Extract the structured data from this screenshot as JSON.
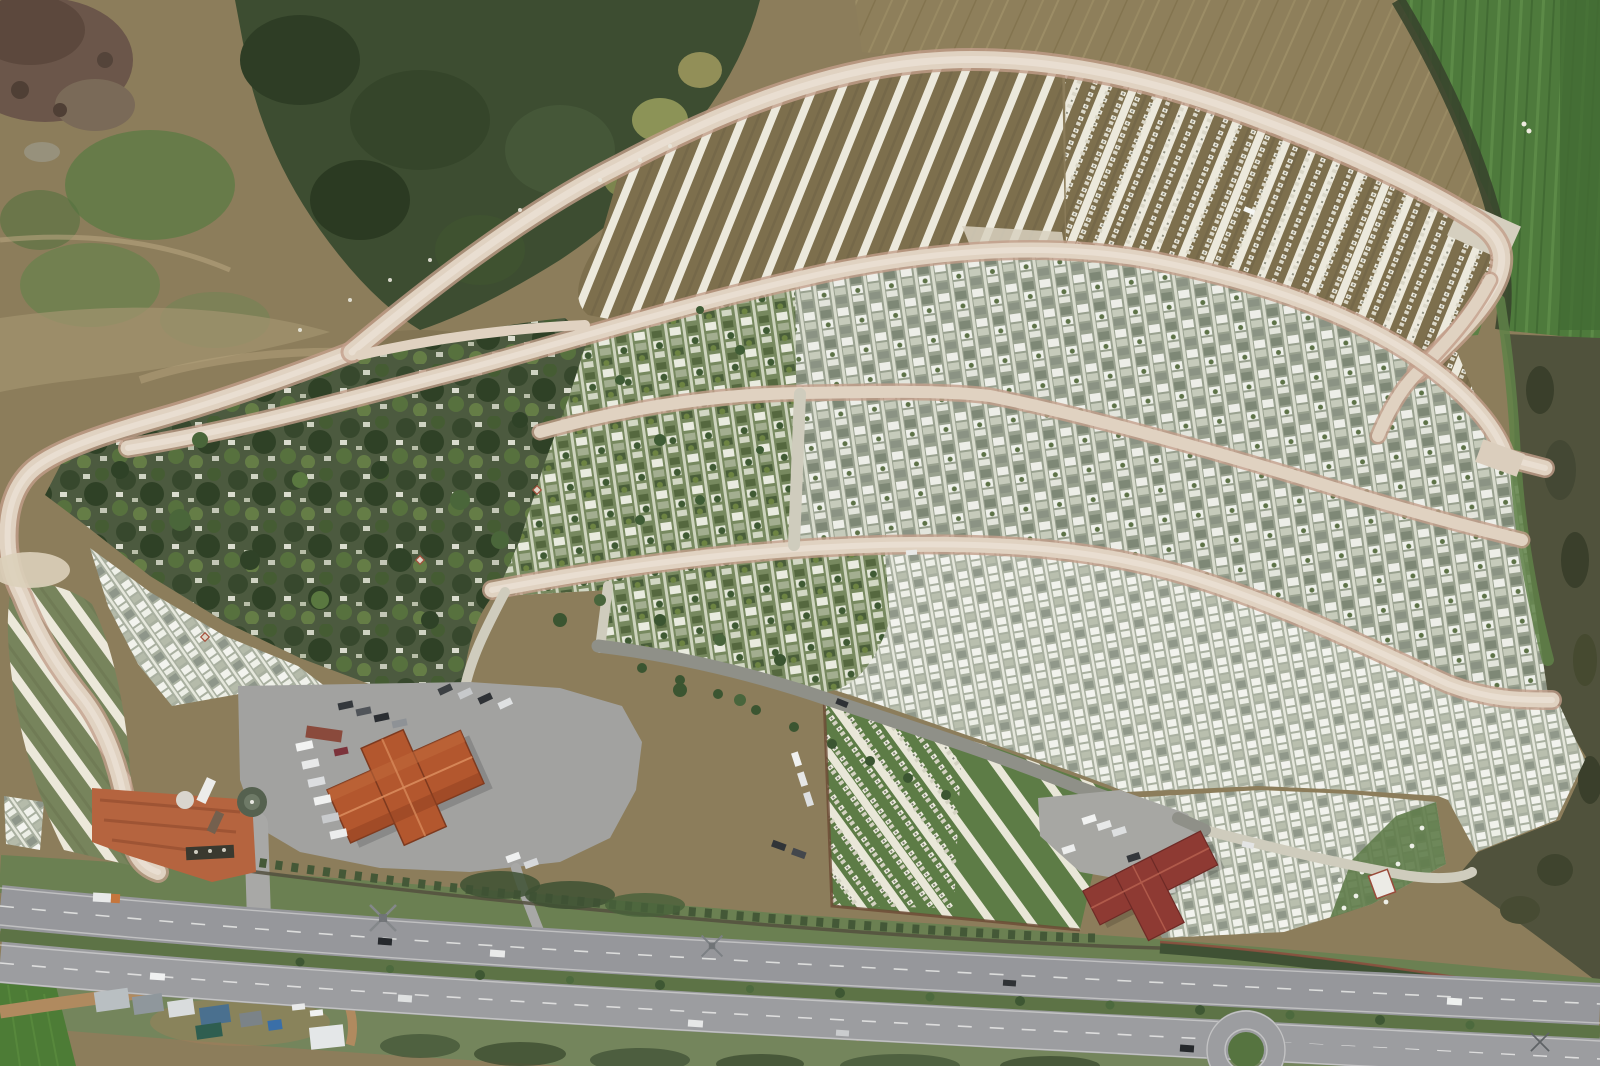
{
  "scene": {
    "type": "aerial-drone-photo",
    "subject": "large hillside cemetery complex with terraced grave rows, service buildings and a divided highway",
    "buildings": 2,
    "roundabouts": 1,
    "highway_carriageways": 2
  },
  "palette": {
    "earth": "#8c7d5b",
    "earth_dark": "#74654a",
    "rubble": "#6b564a",
    "rubble_dark": "#5c483d",
    "forest": "#3d4d31",
    "forest_dark": "#2e3d25",
    "grass_patch": "#5e7a45",
    "plow_field": "#8e7f5b",
    "green_field": "#4e7a3c",
    "green_field_dark": "#426b33",
    "scrub": "#50523c",
    "scrub_dark": "#3a3f2b",
    "scrub_green": "#5f8148",
    "dirt_road": "#e0d2c1",
    "dirt_road_edge": "#c29e89",
    "dirt_road_core": "#ece3d7",
    "asphalt": "#8f9088",
    "asphalt_light": "#a8a8a6",
    "concrete": "#cfccbd",
    "parking": "#a2a2a0",
    "roof_main": "#b3572e",
    "roof_main_ridge": "#d98b5c",
    "roof2": "#8e3a33",
    "roof2_ridge": "#b05a4a",
    "highway_a": "#96979b",
    "highway_b": "#9c9da0",
    "median": "#5d7346",
    "lane": "#e9e9e7",
    "verge": "#6b8052",
    "verge_low": "#74855c",
    "wall": "#53503e",
    "hedge": "#3f5134",
    "wall_red": "#8a4f3e",
    "entry_dirt": "#b5643f",
    "grave_white": "#eceade",
    "tri_grass": "#5d7c46",
    "fan_grass": "#77845c",
    "terrace_ground": "#7d6f4d",
    "old_ground": "#4c5a3f",
    "tree": "#3d5733",
    "bottom_field": "#4d7c36",
    "dirt_track": "#b08a5f"
  }
}
